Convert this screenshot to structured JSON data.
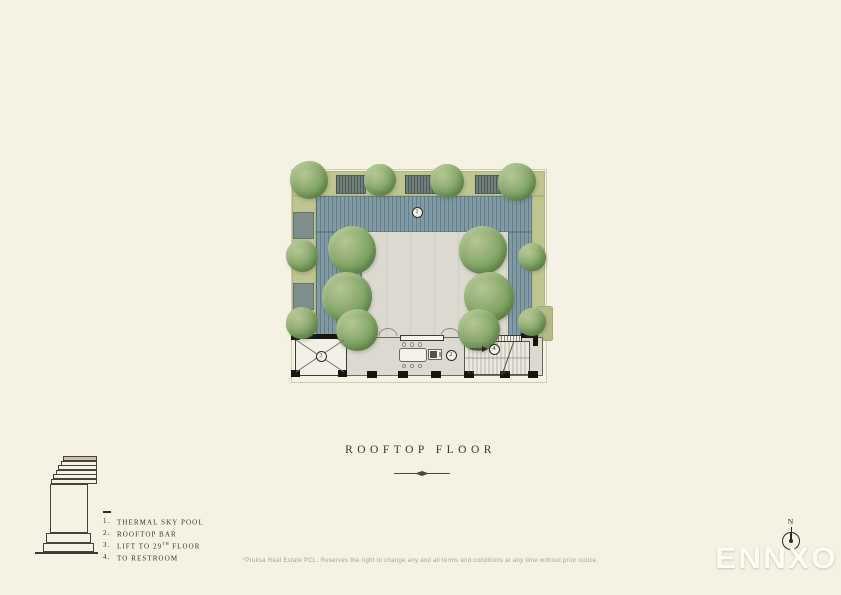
{
  "page": {
    "background_color": "#f5f2e4"
  },
  "title": {
    "text": "ROOFTOP FLOOR"
  },
  "plan": {
    "markers": [
      {
        "label": "1"
      },
      {
        "label": "2"
      },
      {
        "label": "3"
      },
      {
        "label": "4"
      }
    ],
    "colors": {
      "pool": "#829aa4",
      "pool_stripe": "#4b6770",
      "greenery_band": "#bec58f",
      "tree_green": "#79a05e",
      "deck": "#dcd9d0",
      "wall_dark": "#16150f",
      "key_plan_highlight": "#cdc0a0"
    }
  },
  "legend": {
    "items": [
      {
        "num": "1.",
        "pre": "THERMAL SKY POOL",
        "sup": "",
        "post": ""
      },
      {
        "num": "2.",
        "pre": "ROOFTOP BAR",
        "sup": "",
        "post": ""
      },
      {
        "num": "3.",
        "pre": "LIFT TO 29",
        "sup": "TH",
        "post": " FLOOR"
      },
      {
        "num": "4.",
        "pre": "TO RESTROOM",
        "sup": "",
        "post": ""
      }
    ]
  },
  "compass": {
    "label": "N"
  },
  "logo": {
    "text": "ENNXO"
  },
  "disclaimer": {
    "text": "*Pruksa Real Estate PCL. Reserves the right to change any and all terms and conditions at any time without prior notice."
  }
}
